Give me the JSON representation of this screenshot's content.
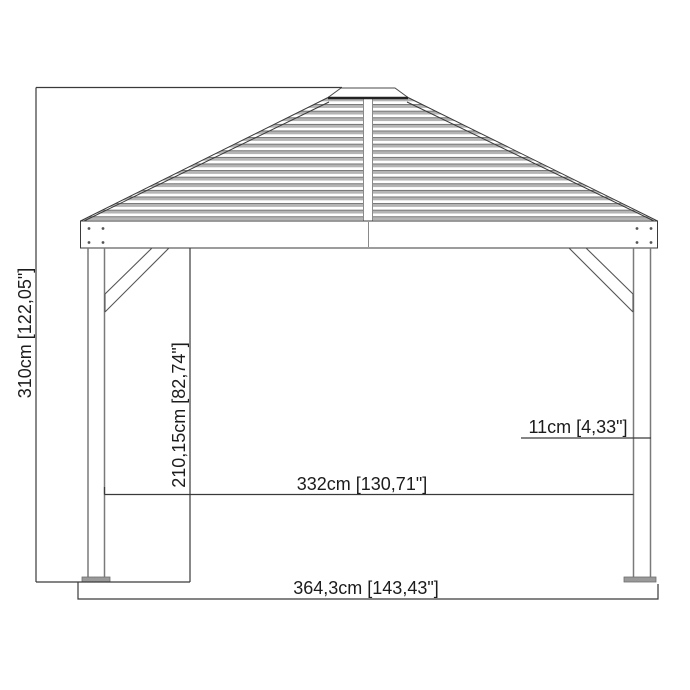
{
  "colors": {
    "line": "#3a3a3a",
    "post_gray": "#7a7a7a",
    "slat_gray": "#b4b4b4",
    "slat_edge": "#6e6e6e",
    "background": "#ffffff"
  },
  "drawing": {
    "dimensions": {
      "total_height": "310cm [122,05\"]",
      "post_height": "210,15cm [82,74\"]",
      "inner_span": "332cm [130,71\"]",
      "post_width": "11cm [4,33\"]",
      "overall_width": "364,3cm [143,43\"]"
    }
  }
}
